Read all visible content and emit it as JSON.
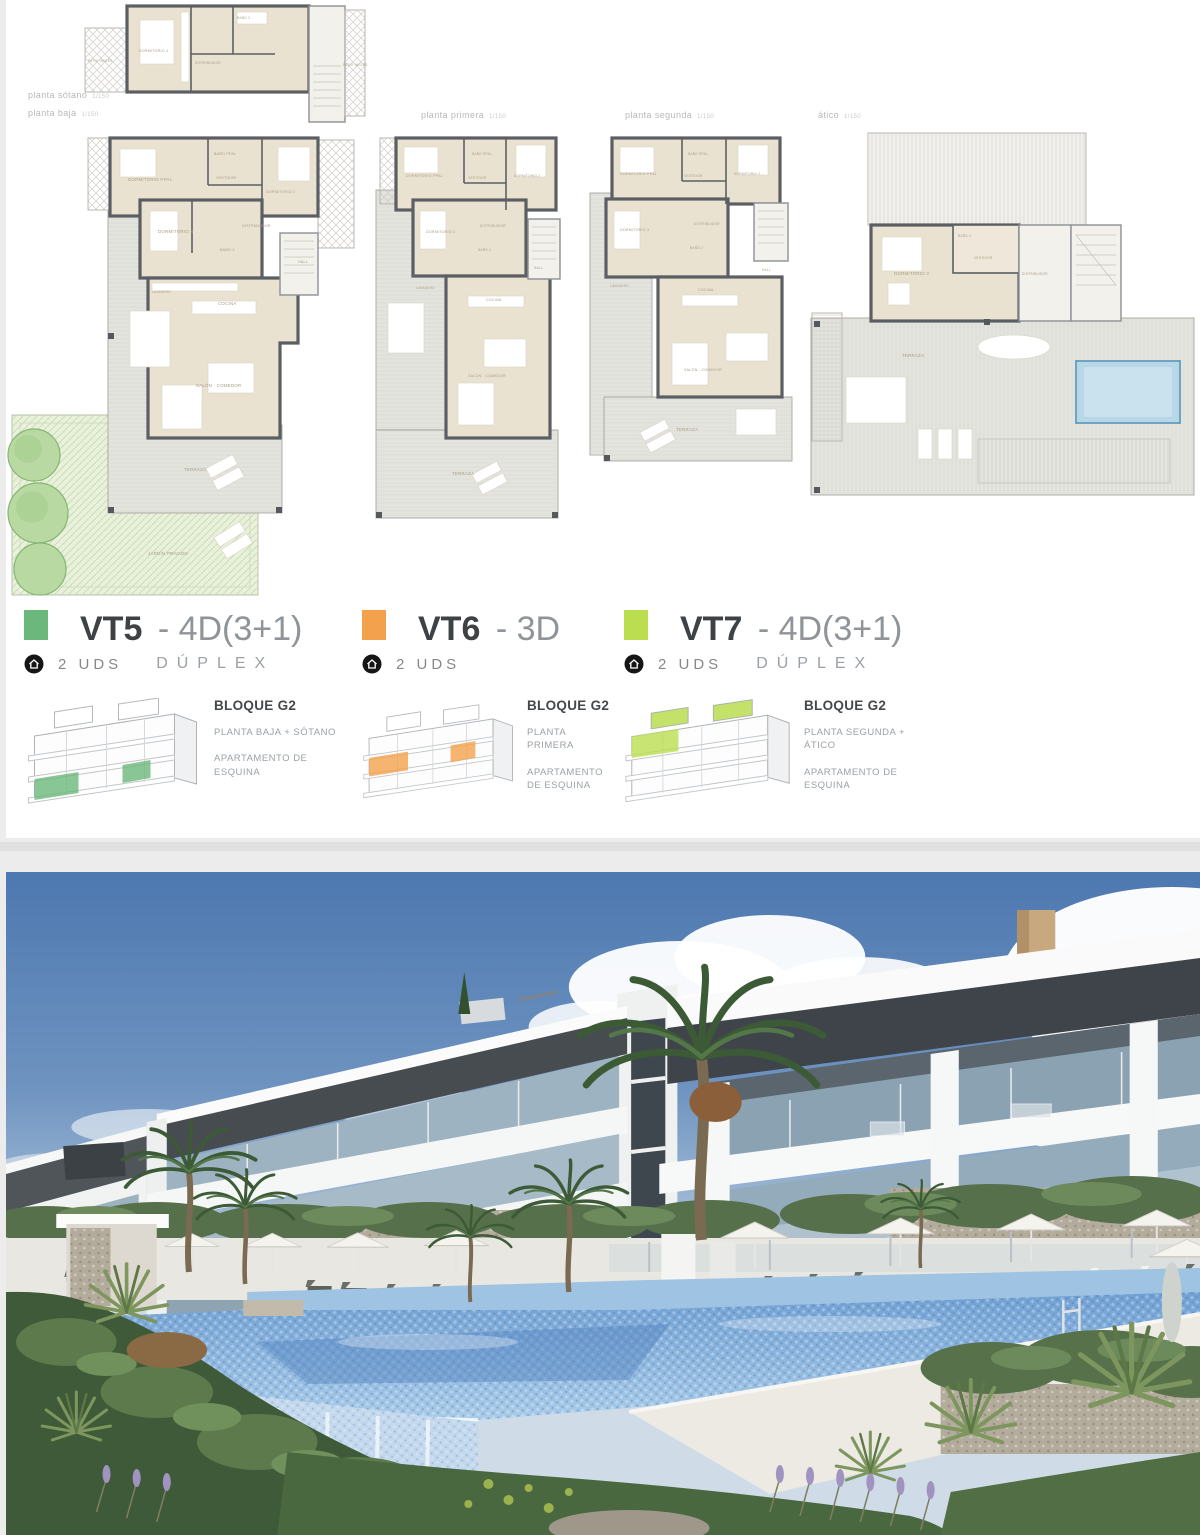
{
  "floors": [
    {
      "label": "planta sótano",
      "scale": "1/150"
    },
    {
      "label": "planta baja",
      "scale": "1/150"
    },
    {
      "label": "planta primera",
      "scale": "1/150"
    },
    {
      "label": "planta segunda",
      "scale": "1/150"
    },
    {
      "label": "ático",
      "scale": "1/150"
    }
  ],
  "plans": {
    "sotano": {
      "rooms": [
        "PATIO INGLÉS",
        "DORMITORIO 4",
        "BAÑO 3",
        "DISTRIBUIDOR",
        "PATIO INGLÉS"
      ]
    },
    "baja": {
      "rooms": [
        "DORMITORIO PPAL",
        "BAÑO PPAL",
        "VESTIDOR",
        "DORMITORIO 2",
        "DORMITORIO 3",
        "BAÑO 2",
        "DISTRIBUIDOR",
        "HALL",
        "LAVADERO",
        "COCINA",
        "SALÓN - COMEDOR",
        "TERRAZA",
        "JARDÍN PRIVADO"
      ]
    },
    "primera": {
      "rooms": [
        "DORMITORIO PPAL",
        "BAÑO PPAL",
        "VESTIDOR",
        "DORMITORIO 2",
        "DORMITORIO 3",
        "BAÑO 2",
        "DISTRIBUIDOR",
        "HALL",
        "LAVADERO",
        "COCINA",
        "SALÓN - COMEDOR",
        "TERRAZA"
      ]
    },
    "segunda": {
      "rooms": [
        "DORMITORIO PPAL",
        "BAÑO PPAL",
        "VESTIDOR",
        "DORMITORIO 2",
        "DORMITORIO 3",
        "BAÑO 2",
        "DISTRIBUIDOR",
        "HALL",
        "LAVADERO",
        "COCINA",
        "SALÓN - COMEDOR",
        "TERRAZA"
      ]
    },
    "atico": {
      "rooms": [
        "DORMITORIO 3",
        "BAÑO 3",
        "VESTIDOR",
        "DISTRIBUIDOR",
        "TERRAZA"
      ]
    }
  },
  "legend": {
    "items": [
      {
        "code": "VT5",
        "suffix": "- 4D(3+1)",
        "units": "2 UDS",
        "duplex": "DÚPLEX",
        "block": "BLOQUE G2",
        "floor": "PLANTA BAJA + SÓTANO",
        "position": "APARTAMENTO DE ESQUINA",
        "color": "#6cb87c"
      },
      {
        "code": "VT6",
        "suffix": "- 3D",
        "units": "2 UDS",
        "duplex": "",
        "block": "BLOQUE G2",
        "floor": "PLANTA PRIMERA",
        "position": "APARTAMENTO DE ESQUINA",
        "color": "#f4a14e"
      },
      {
        "code": "VT7",
        "suffix": "- 4D(3+1)",
        "units": "2 UDS",
        "duplex": "DÚPLEX",
        "block": "BLOQUE G2",
        "floor": "PLANTA SEGUNDA + ÁTICO",
        "position": "APARTAMENTO DE ESQUINA",
        "color": "#bade50"
      }
    ]
  },
  "colors": {
    "vt5_green": "#6cb87c",
    "vt6_orange": "#f4a14e",
    "vt7_lime": "#bade50",
    "plan_room_beige": "#eae2d1",
    "plan_wall_gray": "#5b5f63",
    "plan_terrace": "#e4e4df",
    "plan_garden": "#e9f1dc",
    "plan_pool": "#b8d7e6",
    "photo_sky": "#4d78b0",
    "photo_pool": "#7aa8d8",
    "photo_fascia": "#3f444a"
  }
}
